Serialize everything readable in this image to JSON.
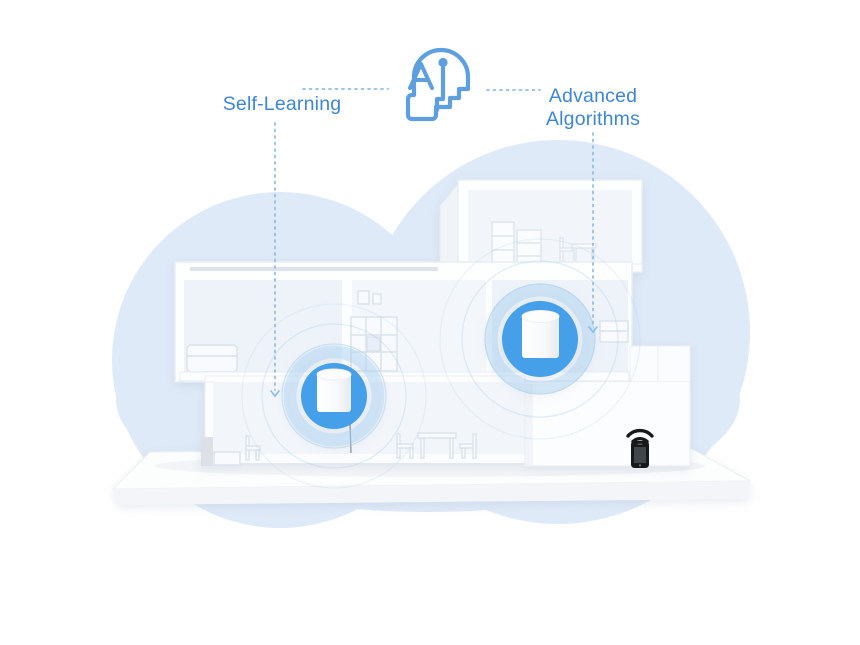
{
  "page": {
    "background": "#ffffff",
    "callouts": {
      "left_label": "Self-Learning",
      "right_label": "Advanced Algorithms"
    },
    "icons": {
      "ai_head": "ai-head-icon",
      "wifi": "wifi-signal-icon",
      "smartphone": "smartphone-icon",
      "mesh_unit_left": "mesh-wifi-unit",
      "mesh_unit_right": "mesh-wifi-unit"
    },
    "colors": {
      "label_text": "#3e86d2",
      "ai_icon_stroke": "#5e9fe0",
      "connector_dotted": "#8fbbe6",
      "mesh_unit_circle": "#459fe9",
      "mesh_unit_halo": "#a9d2f2",
      "cloud_fill": "#dfeaf8",
      "device_icon": "#17181a",
      "house_white": "#fdfefe",
      "platform_face": "#f3f5f8"
    }
  }
}
